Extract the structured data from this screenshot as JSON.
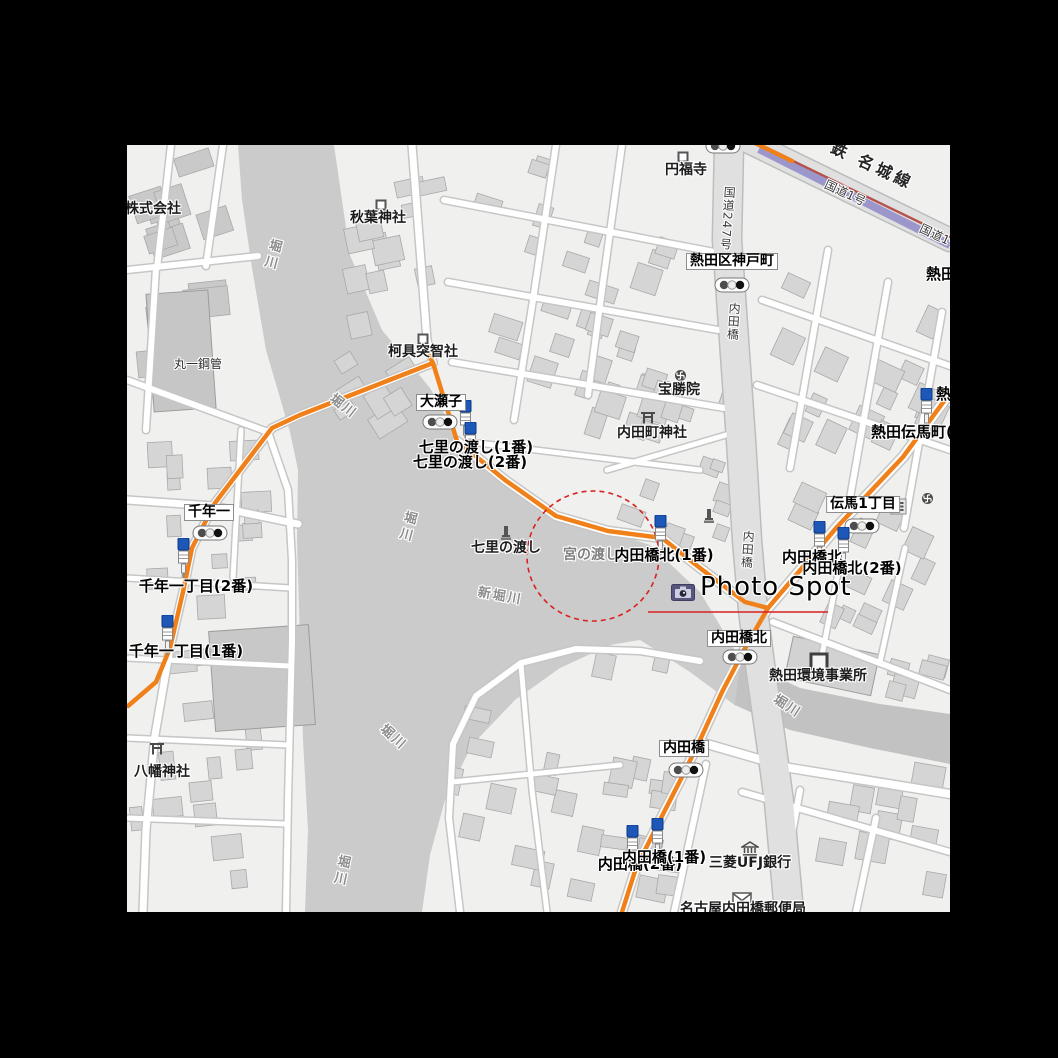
{
  "annotation": {
    "photo_spot_label": "Photo Spot",
    "colors": {
      "annotation_red": "#d92121",
      "marker_bg": "#56567e"
    }
  },
  "map": {
    "colors": {
      "land": "#f0f0ee",
      "water": "#cbcbcb",
      "water_dark": "#c2c2c2",
      "route_orange": "#f08019",
      "rail_purple": "#9c97cb",
      "rail_red": "#b5524c",
      "building": "#d5d5d5",
      "road_minor": "#ffffff",
      "road_major": "#e0e0e0"
    },
    "labels": [
      {
        "id": "kabushiki",
        "text": "株式会社",
        "kind": "poi",
        "x": 125,
        "y": 202,
        "anchor": "left"
      },
      {
        "id": "maruichi",
        "text": "丸一鋼管",
        "kind": "poi-sm",
        "x": 198,
        "y": 358
      },
      {
        "id": "akiba-jinja",
        "text": "秋葉神社",
        "kind": "poi",
        "x": 378,
        "y": 211
      },
      {
        "id": "enpukuji",
        "text": "円福寺",
        "kind": "poi",
        "x": 686,
        "y": 163
      },
      {
        "id": "kagutsuchi-sha",
        "text": "柯具突智社",
        "kind": "poi",
        "x": 423,
        "y": 345
      },
      {
        "id": "hoshoin",
        "text": "宝勝院",
        "kind": "poi",
        "x": 679,
        "y": 383
      },
      {
        "id": "uchidacho-jinja",
        "text": "内田町神社",
        "kind": "poi",
        "x": 652,
        "y": 426
      },
      {
        "id": "kankyo-jigyosho",
        "text": "熱田環境事業所",
        "kind": "poi",
        "x": 818,
        "y": 669
      },
      {
        "id": "hachiman-jinja",
        "text": "八幡神社",
        "kind": "poi",
        "x": 162,
        "y": 765
      },
      {
        "id": "mitsubishi-ufj",
        "text": "三菱UFJ銀行",
        "kind": "poi",
        "x": 750,
        "y": 856
      },
      {
        "id": "uchidabashi-yubinkyoku",
        "text": "名古屋内田橋郵便局",
        "kind": "poi",
        "x": 743,
        "y": 902
      },
      {
        "id": "shichiri-no-watashi-site",
        "text": "七里の渡し",
        "kind": "poi",
        "x": 506,
        "y": 541
      },
      {
        "id": "miya-no-watashi",
        "text": "宮の渡し",
        "kind": "park",
        "x": 591,
        "y": 548
      },
      {
        "id": "oseko-box",
        "text": "大瀬子",
        "kind": "box",
        "x": 441,
        "y": 394
      },
      {
        "id": "sennen-box",
        "text": "千年一",
        "kind": "box",
        "x": 209,
        "y": 504
      },
      {
        "id": "kobe-box",
        "text": "熱田区神戸町",
        "kind": "box",
        "x": 732,
        "y": 253
      },
      {
        "id": "denma-box",
        "text": "伝馬1丁目",
        "kind": "box",
        "x": 863,
        "y": 496
      },
      {
        "id": "uchidabashi-kita-box",
        "text": "内田橋北",
        "kind": "box",
        "x": 739,
        "y": 630
      },
      {
        "id": "uchidabashi-box",
        "text": "内田橋",
        "kind": "box",
        "x": 684,
        "y": 740
      },
      {
        "id": "shichiri-bus-2",
        "text": "七里の渡し(2番)",
        "kind": "bus",
        "x": 470,
        "y": 455
      },
      {
        "id": "shichiri-bus-1",
        "text": "七里の渡し(1番)",
        "kind": "bus",
        "x": 476,
        "y": 440
      },
      {
        "id": "uchidabashi-kita-bus-partial",
        "text": "内田橋北",
        "kind": "bus",
        "x": 812,
        "y": 550
      },
      {
        "id": "uchidabashi-kita-bus-2",
        "text": "内田橋北(2番)",
        "kind": "bus",
        "x": 852,
        "y": 561
      },
      {
        "id": "uchidabashi-kita-bus-1",
        "text": "内田橋北(1番)",
        "kind": "bus",
        "x": 664,
        "y": 548
      },
      {
        "id": "atsuta-tenmacho-bus",
        "text": "熱田伝馬町(",
        "kind": "bus",
        "x": 871,
        "y": 425,
        "anchor": "left"
      },
      {
        "id": "atsuta-partial-top",
        "text": "熱田",
        "kind": "bus",
        "x": 926,
        "y": 267,
        "anchor": "left"
      },
      {
        "id": "atsuta-partial-mid",
        "text": "熱田",
        "kind": "bus",
        "x": 936,
        "y": 387,
        "anchor": "left"
      },
      {
        "id": "sennen-bus-2",
        "text": "千年一丁目(2番)",
        "kind": "bus",
        "x": 196,
        "y": 579
      },
      {
        "id": "sennen-bus-1",
        "text": "千年一丁目(1番)",
        "kind": "bus",
        "x": 186,
        "y": 644
      },
      {
        "id": "uchidabashi-bus-2",
        "text": "内田橋(2番)",
        "kind": "bus",
        "x": 640,
        "y": 857
      },
      {
        "id": "uchidabashi-bus-1",
        "text": "内田橋(1番)",
        "kind": "bus",
        "x": 664,
        "y": 850
      },
      {
        "id": "horikawa-1",
        "text": "堀川",
        "kind": "river-v",
        "x": 271,
        "y": 238,
        "rot": 15
      },
      {
        "id": "horikawa-2",
        "text": "堀川",
        "kind": "river-h",
        "x": 343,
        "y": 400,
        "rot": 38
      },
      {
        "id": "horikawa-3",
        "text": "堀川",
        "kind": "river-v",
        "x": 406,
        "y": 510,
        "rot": 15
      },
      {
        "id": "shin-horikawa",
        "text": "新堀川",
        "kind": "river-h",
        "x": 500,
        "y": 590,
        "rot": 10
      },
      {
        "id": "horikawa-4",
        "text": "堀川",
        "kind": "river-h",
        "x": 787,
        "y": 700,
        "rot": 33
      },
      {
        "id": "horikawa-5",
        "text": "堀川",
        "kind": "river-h",
        "x": 393,
        "y": 731,
        "rot": 42
      },
      {
        "id": "horikawa-6",
        "text": "堀川",
        "kind": "river-v",
        "x": 340,
        "y": 854,
        "rot": 12
      },
      {
        "id": "route-247",
        "text": "国道247号",
        "kind": "road-v",
        "x": 727,
        "y": 186,
        "rot": 4
      },
      {
        "id": "uchidabashi-road-1",
        "text": "内田橋",
        "kind": "road-v",
        "x": 733,
        "y": 302,
        "rot": 4
      },
      {
        "id": "uchidabashi-road-2",
        "text": "内田橋",
        "kind": "road-v",
        "x": 747,
        "y": 530,
        "rot": 4
      },
      {
        "id": "kokudo-1-a",
        "text": "国道1号",
        "kind": "road-h",
        "x": 845,
        "y": 187,
        "rot": 25
      },
      {
        "id": "kokudo-1-b",
        "text": "国道1号",
        "kind": "road-h",
        "x": 940,
        "y": 231,
        "rot": 25
      },
      {
        "id": "meijo-line",
        "text": "鉄 名城線",
        "kind": "rail",
        "x": 872,
        "y": 158,
        "rot": 25
      },
      {
        "id": "photo-spot-label",
        "text": "Photo Spot",
        "kind": "photo",
        "x": 700,
        "y": 574,
        "anchor": "left"
      }
    ],
    "icons": [
      {
        "type": "signal",
        "x": 440,
        "y": 422
      },
      {
        "type": "signal",
        "x": 210,
        "y": 533
      },
      {
        "type": "signal",
        "x": 732,
        "y": 285
      },
      {
        "type": "signal",
        "x": 862,
        "y": 526
      },
      {
        "type": "signal",
        "x": 740,
        "y": 657
      },
      {
        "type": "signal",
        "x": 686,
        "y": 770
      },
      {
        "type": "signal",
        "x": 723,
        "y": 146
      },
      {
        "type": "busstop",
        "x": 465,
        "y": 420
      },
      {
        "type": "busstop",
        "x": 470,
        "y": 442
      },
      {
        "type": "busstop",
        "x": 660,
        "y": 535
      },
      {
        "type": "busstop",
        "x": 819,
        "y": 541
      },
      {
        "type": "busstop",
        "x": 843,
        "y": 547
      },
      {
        "type": "busstop",
        "x": 926,
        "y": 408
      },
      {
        "type": "busstop",
        "x": 183,
        "y": 558
      },
      {
        "type": "busstop",
        "x": 167,
        "y": 635
      },
      {
        "type": "busstop",
        "x": 632,
        "y": 845
      },
      {
        "type": "busstop",
        "x": 657,
        "y": 838
      },
      {
        "type": "torii",
        "x": 648,
        "y": 416
      },
      {
        "type": "torii",
        "x": 157,
        "y": 747
      },
      {
        "type": "shrine-square",
        "x": 381,
        "y": 202
      },
      {
        "type": "shrine-square",
        "x": 683,
        "y": 154
      },
      {
        "type": "shrine-square",
        "x": 423,
        "y": 336
      },
      {
        "type": "office-square",
        "x": 819,
        "y": 662
      },
      {
        "type": "manji",
        "x": 680,
        "y": 373
      },
      {
        "type": "manji",
        "x": 927,
        "y": 496
      },
      {
        "type": "monument",
        "x": 506,
        "y": 533
      },
      {
        "type": "monument",
        "x": 709,
        "y": 516
      },
      {
        "type": "bank",
        "x": 750,
        "y": 849
      },
      {
        "type": "post",
        "x": 742,
        "y": 899
      },
      {
        "type": "parking-lines",
        "x": 898,
        "y": 506
      },
      {
        "type": "camera",
        "x": 683,
        "y": 592
      }
    ]
  }
}
